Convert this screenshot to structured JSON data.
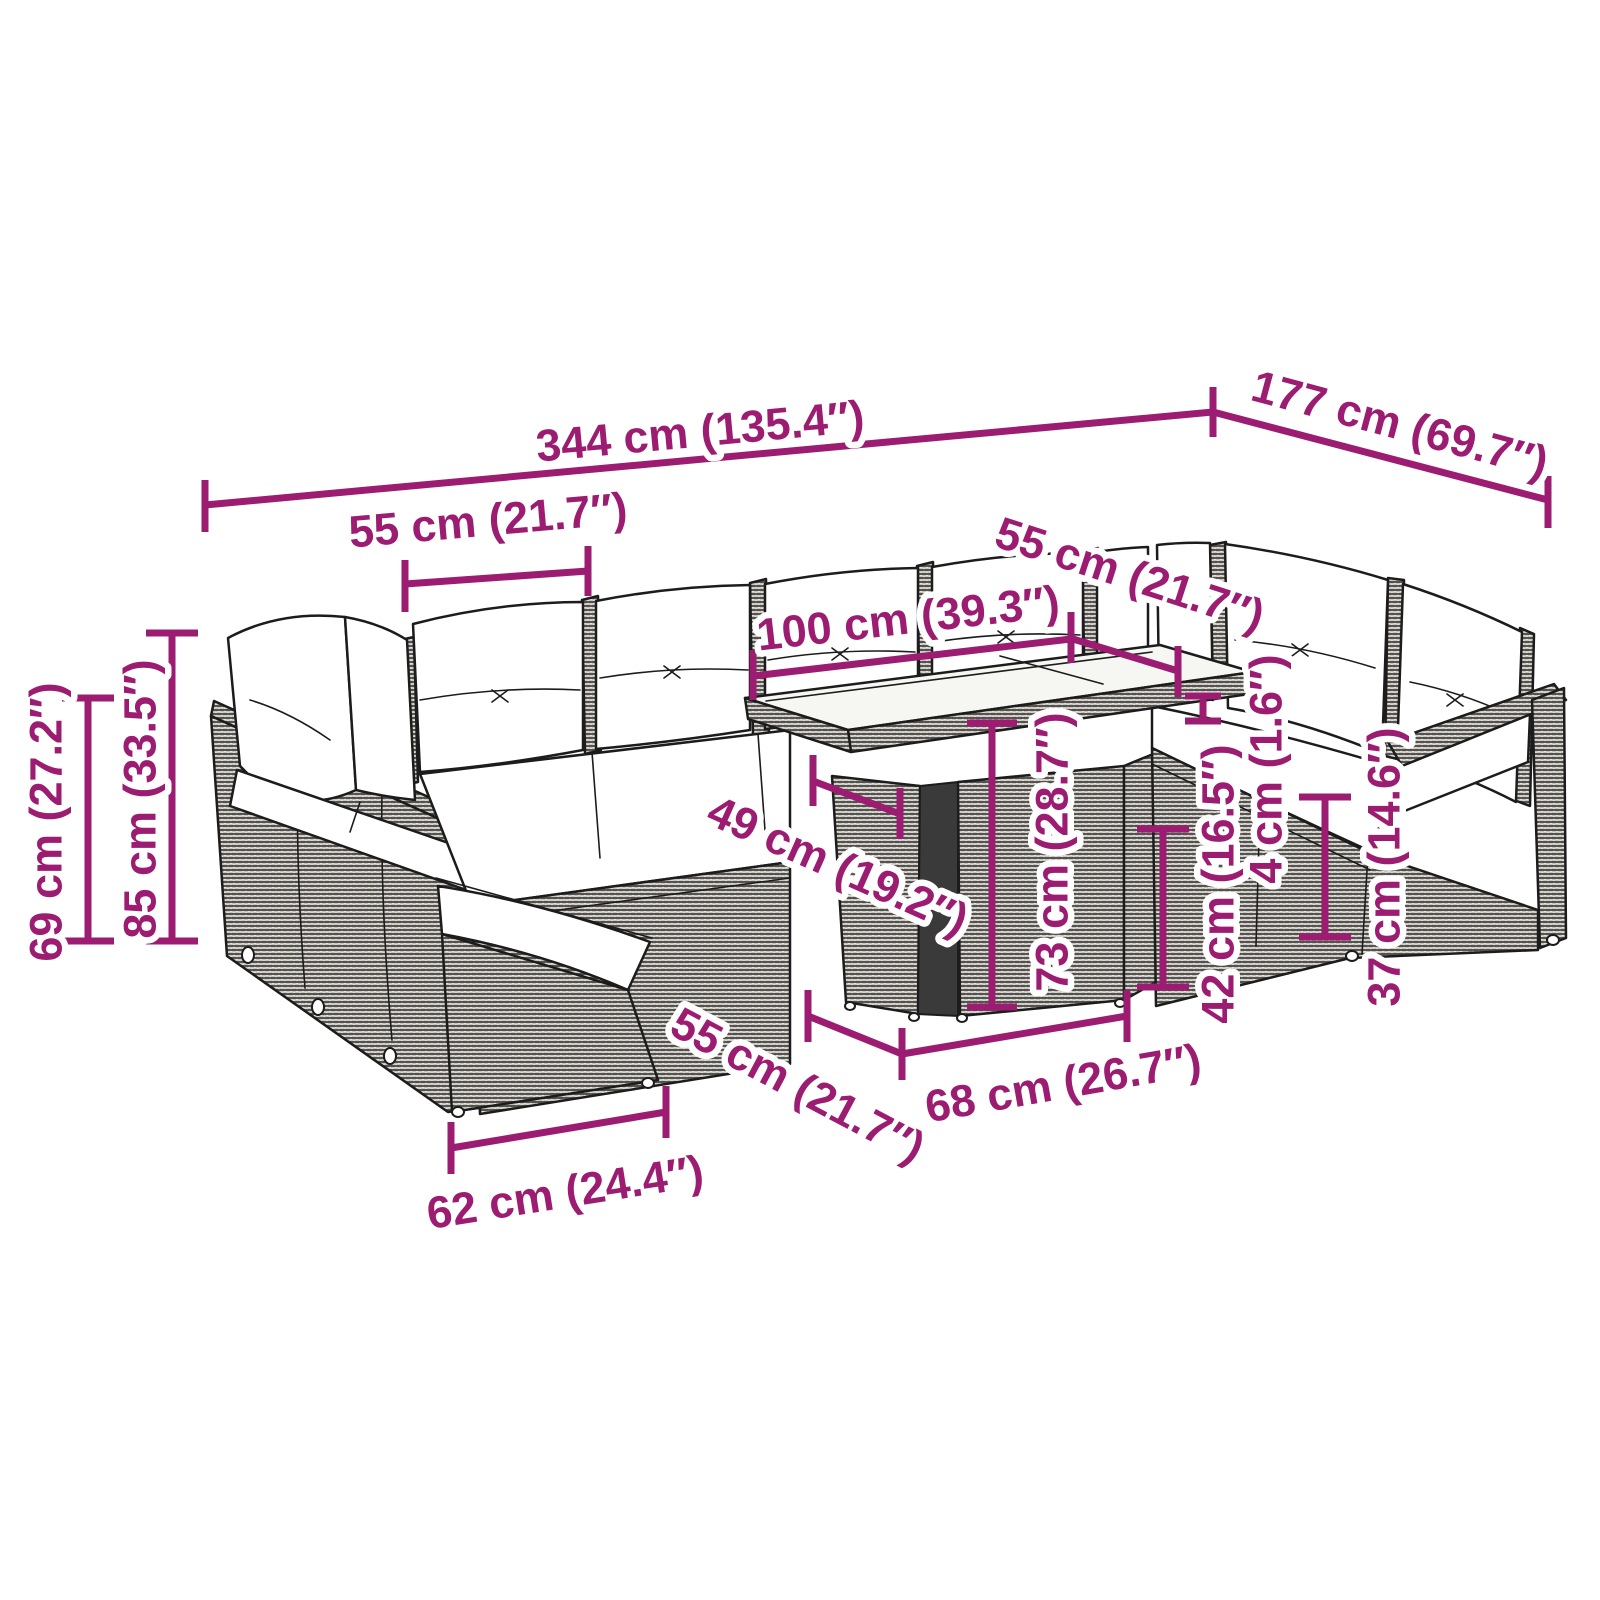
{
  "accent_color": "#9B1C70",
  "line_art_color": "#1C1C1C",
  "cushion_color": "#FFFFFF",
  "glass_color": "#F6F6F2",
  "dims": {
    "overall_width": "344 cm (135.4″)",
    "overall_depth": "177 cm (69.7″)",
    "seat_width_back": "55 cm (21.7″)",
    "seat_width_right": "55 cm (21.7″)",
    "seat_width_front": "55 cm (21.7″)",
    "table_length": "100 cm (39.3″)",
    "table_depth": "49 cm (19.2″)",
    "table_height": "73 cm (28.7″)",
    "table_base_height": "42 cm (16.5″)",
    "tabletop_thickness": "4 cm (1.6″)",
    "seat_height": "37 cm (14.6″)",
    "back_height": "69 cm (27.2″)",
    "overall_height": "85 cm (33.5″)",
    "module_width": "62 cm (24.4″)",
    "table_base_length": "68 cm (26.7″)"
  }
}
